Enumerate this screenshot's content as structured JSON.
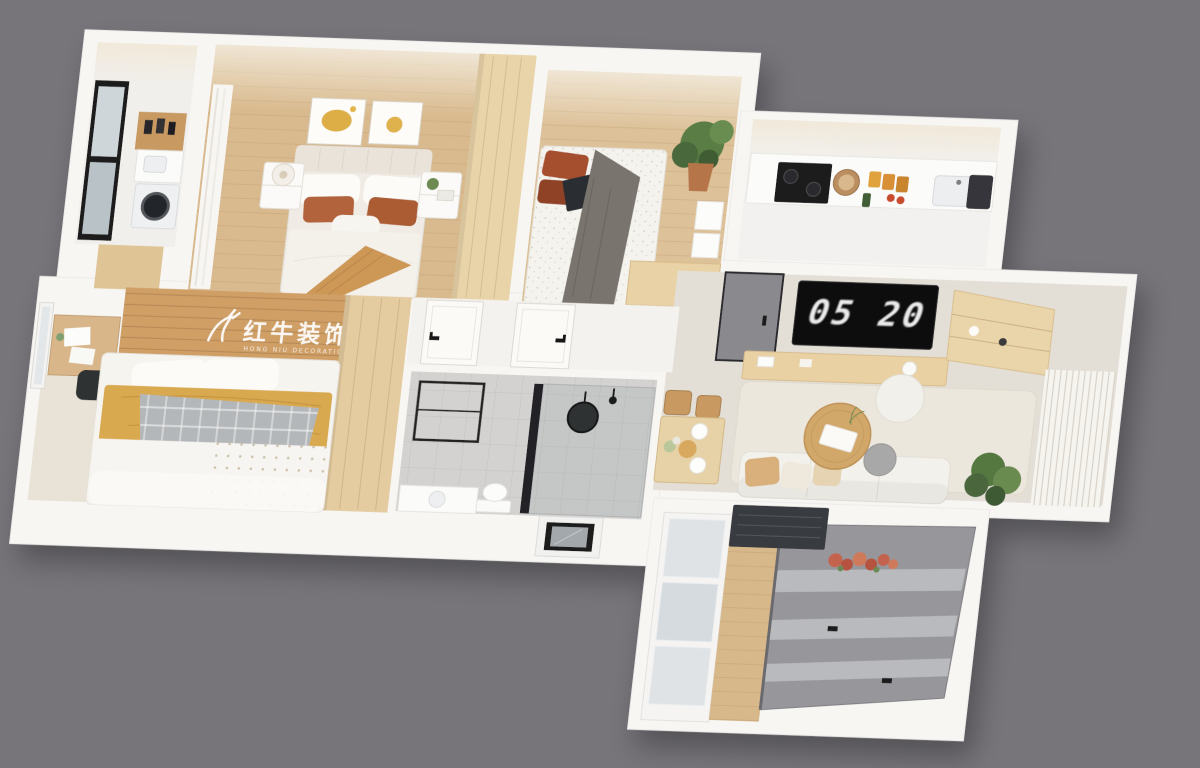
{
  "scene": {
    "type": "3d-isometric-floorplan-render",
    "background_color": "#77757a",
    "wall_color": "#f7f6f3"
  },
  "watermark": {
    "logo": "deer-swoosh-logo",
    "brand": "红牛装饰",
    "subtitle": "HONG NIU DECORATION",
    "color": "#ffffff"
  },
  "living_room": {
    "tv_clock": "05 20",
    "tv_screen_color": "#0a0a0b"
  },
  "palette": {
    "wood_floor": "#d9ba8e",
    "wood_band": "#cf9f66",
    "wood_furniture": "#e7d1a7",
    "wardrobe_wood": "#e9d3a8",
    "accent_rust": "#b2643a",
    "accent_mustard": "#d9a94f",
    "accent_tan_throw": "#cd9757",
    "plant_green": "#55773f",
    "coral_plant": "#c4634d",
    "bathroom_tile": "#d3d2d0",
    "gray_window_frames": "#97969a",
    "entry_door_gray": "#8a898d",
    "tv_black": "#0a0a0b"
  },
  "rooms": [
    {
      "id": "laundry-balcony",
      "furniture": [
        "black-frame-window",
        "wood-shelf",
        "bottles",
        "sink-counter",
        "washing-machine",
        "wood-door"
      ]
    },
    {
      "id": "master-bedroom",
      "furniture": [
        "wall-art-pair",
        "curtain",
        "double-bed",
        "rust-pillows",
        "tan-throw",
        "nightstand-lamp",
        "nightstand-plant",
        "wardrobe"
      ]
    },
    {
      "id": "bedroom-2",
      "furniture": [
        "single-bed",
        "rust-pillows",
        "gray-blanket",
        "laptop",
        "potted-plant",
        "desk",
        "wall-panels"
      ]
    },
    {
      "id": "kitchen",
      "furniture": [
        "counter",
        "gas-stove",
        "pot",
        "spice-jars",
        "sink",
        "dark-tray"
      ]
    },
    {
      "id": "living-dining",
      "furniture": [
        "entry-door",
        "wall-tv-clock",
        "tv-console",
        "corner-shelf",
        "curtain-wall",
        "rug",
        "sofa",
        "coffee-table",
        "side-table",
        "pouf",
        "dining-table",
        "dining-chairs",
        "corner-plant"
      ]
    },
    {
      "id": "hallway",
      "furniture": [
        "white-door",
        "white-door"
      ]
    },
    {
      "id": "bathroom",
      "furniture": [
        "towel-frame",
        "shower-glass",
        "round-mirror",
        "toilet",
        "vanity"
      ]
    },
    {
      "id": "bedroom-3",
      "furniture": [
        "window-shade",
        "desk",
        "papers",
        "chair",
        "bed",
        "mustard-blanket",
        "plaid-throw",
        "wardrobe",
        "watermark"
      ]
    },
    {
      "id": "south-balcony",
      "furniture": [
        "white-windows",
        "wood-floor-strip",
        "gray-sliding-windows",
        "ac-unit",
        "coral-plant",
        "skylight-window"
      ]
    }
  ]
}
